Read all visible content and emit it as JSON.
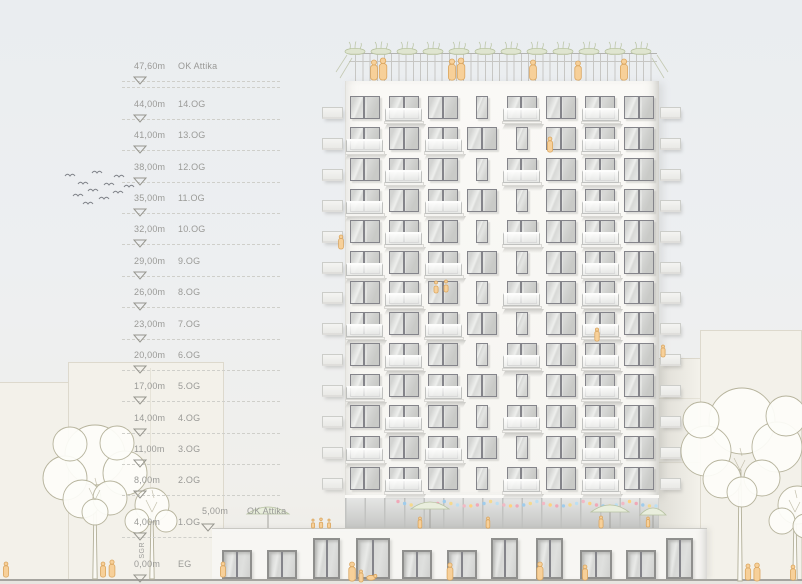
{
  "drawing": {
    "type": "building elevation",
    "levels": [
      {
        "value": "47,60m",
        "label": "OK Attika",
        "m": 47.6,
        "double_dash": true
      },
      {
        "value": "44,00m",
        "label": "14.OG",
        "m": 44
      },
      {
        "value": "41,00m",
        "label": "13.OG",
        "m": 41
      },
      {
        "value": "38,00m",
        "label": "12.OG",
        "m": 38
      },
      {
        "value": "35,00m",
        "label": "11.OG",
        "m": 35
      },
      {
        "value": "32,00m",
        "label": "10.OG",
        "m": 32
      },
      {
        "value": "29,00m",
        "label": "9.OG",
        "m": 29
      },
      {
        "value": "26,00m",
        "label": "8.OG",
        "m": 26
      },
      {
        "value": "23,00m",
        "label": "7.OG",
        "m": 23
      },
      {
        "value": "20,00m",
        "label": "6.OG",
        "m": 20
      },
      {
        "value": "17,00m",
        "label": "5.OG",
        "m": 17
      },
      {
        "value": "14,00m",
        "label": "4.OG",
        "m": 14
      },
      {
        "value": "11,00m",
        "label": "3.OG",
        "m": 11
      },
      {
        "value": "8,00m",
        "label": "2.OG",
        "m": 8
      },
      {
        "value": "4,00m",
        "label": "1.OG",
        "m": 4,
        "short": true
      },
      {
        "value": "0,00m",
        "label": "EG",
        "m": 0,
        "no_dash": true
      }
    ],
    "podium_marker": {
      "value": "5,00m",
      "label": "OK Attika"
    },
    "side_note": "SGR"
  },
  "colors": {
    "sky": "#eaedf0",
    "facade": "#f8f7f4",
    "window_frame": "#84848a",
    "people_accent": "#f7d099",
    "greenery": "#b6c19e",
    "marker_text": "#9a9a97",
    "street_line": "#a5a49f"
  },
  "tower": {
    "bays": 8,
    "floors": 13,
    "row_patterns": [
      "wbwnbwbw",
      "bwbwnwbw",
      "wbwnbwbw",
      "bwbwnwbw",
      "wbwnbwbw",
      "bwbwnwbw",
      "wbwnbwbw",
      "bwbwnwbw",
      "wbwnbwbw",
      "bwbwnwbw",
      "wbwnbwbw",
      "bwbwnwbw",
      "wbwnbwbw"
    ]
  },
  "storefront": {
    "openings": [
      {
        "x": 222,
        "w": 30,
        "t": "w"
      },
      {
        "x": 267,
        "w": 30,
        "t": "w"
      },
      {
        "x": 313,
        "w": 27,
        "t": "d"
      },
      {
        "x": 356,
        "w": 34,
        "t": "d"
      },
      {
        "x": 402,
        "w": 30,
        "t": "w"
      },
      {
        "x": 447,
        "w": 30,
        "t": "w"
      },
      {
        "x": 491,
        "w": 27,
        "t": "d"
      },
      {
        "x": 536,
        "w": 27,
        "t": "d"
      },
      {
        "x": 580,
        "w": 32,
        "t": "w"
      },
      {
        "x": 626,
        "w": 30,
        "t": "w"
      },
      {
        "x": 666,
        "w": 27,
        "t": "d"
      }
    ]
  },
  "scenery": {
    "bg_buildings": [
      {
        "x": -8,
        "y": 382,
        "w": 96
      },
      {
        "x": 68,
        "y": 362,
        "w": 156,
        "vlines": [
          150
        ]
      },
      {
        "x": 652,
        "y": 358,
        "w": 150,
        "hlines": [
          398,
          462
        ],
        "vlines": [
          700,
          758
        ]
      },
      {
        "x": 700,
        "y": 330,
        "w": 102
      }
    ],
    "trees": [
      {
        "x": 95,
        "base": 579,
        "top": 500,
        "blobs": [
          [
            95,
            455,
            30
          ],
          [
            65,
            478,
            22
          ],
          [
            125,
            473,
            22
          ],
          [
            82,
            499,
            19
          ],
          [
            110,
            498,
            17
          ],
          [
            70,
            444,
            17
          ],
          [
            117,
            443,
            17
          ],
          [
            95,
            512,
            13
          ]
        ]
      },
      {
        "x": 152,
        "base": 579,
        "top": 512,
        "blobs": [
          [
            152,
            505,
            17
          ],
          [
            137,
            521,
            12
          ],
          [
            166,
            521,
            11
          ]
        ]
      },
      {
        "x": 740,
        "base": 581,
        "top": 470,
        "blobs": [
          [
            742,
            421,
            33
          ],
          [
            706,
            451,
            25
          ],
          [
            777,
            447,
            25
          ],
          [
            722,
            479,
            19
          ],
          [
            762,
            478,
            18
          ],
          [
            701,
            420,
            18
          ],
          [
            786,
            416,
            20
          ],
          [
            742,
            492,
            15
          ]
        ]
      },
      {
        "x": 795,
        "base": 580,
        "top": 512,
        "blobs": [
          [
            797,
            505,
            19
          ],
          [
            782,
            521,
            13
          ],
          [
            805,
            526,
            12
          ]
        ]
      }
    ],
    "birds": [
      [
        70,
        176
      ],
      [
        83,
        184
      ],
      [
        97,
        173
      ],
      [
        78,
        196
      ],
      [
        93,
        191
      ],
      [
        109,
        185
      ],
      [
        119,
        177
      ],
      [
        88,
        204
      ],
      [
        104,
        199
      ],
      [
        118,
        193
      ],
      [
        129,
        187
      ]
    ],
    "umbrellas": [
      {
        "x": 268,
        "y": 505,
        "w": 42
      },
      {
        "x": 430,
        "y": 500,
        "w": 38
      },
      {
        "x": 610,
        "y": 503,
        "w": 38
      },
      {
        "x": 653,
        "y": 506,
        "w": 26
      }
    ],
    "bunting": {
      "x0": 398,
      "x1": 656,
      "count": 40,
      "colors": [
        "#f0a9b8",
        "#9fccec",
        "#f5d98d",
        "#bcdff2",
        "#f2b9c5",
        "#ffd27e"
      ]
    },
    "roof_planters_x": [
      355,
      381,
      407,
      433,
      459,
      485,
      511,
      537,
      563,
      589,
      615,
      641
    ],
    "people": [
      {
        "x": 374,
        "y": 80,
        "h": 20
      },
      {
        "x": 383,
        "y": 80,
        "h": 22
      },
      {
        "x": 452,
        "y": 80,
        "h": 21
      },
      {
        "x": 461,
        "y": 80,
        "h": 22
      },
      {
        "x": 533,
        "y": 80,
        "h": 20
      },
      {
        "x": 578,
        "y": 80,
        "h": 19
      },
      {
        "x": 624,
        "y": 80,
        "h": 21
      },
      {
        "x": 313,
        "y": 528,
        "h": 9,
        "k": "sit"
      },
      {
        "x": 321,
        "y": 528,
        "h": 10,
        "k": "sit"
      },
      {
        "x": 329,
        "y": 528,
        "h": 9,
        "k": "sit"
      },
      {
        "x": 420,
        "y": 528,
        "h": 11
      },
      {
        "x": 488,
        "y": 528,
        "h": 11
      },
      {
        "x": 601,
        "y": 528,
        "h": 12
      },
      {
        "x": 648,
        "y": 527,
        "h": 10
      },
      {
        "x": 550,
        "y": 152,
        "h": 15
      },
      {
        "x": 341,
        "y": 249,
        "h": 14
      },
      {
        "x": 436,
        "y": 293,
        "h": 12,
        "k": "sit"
      },
      {
        "x": 446,
        "y": 292,
        "h": 12,
        "k": "sit"
      },
      {
        "x": 663,
        "y": 357,
        "h": 12
      },
      {
        "x": 597,
        "y": 341,
        "h": 13
      },
      {
        "x": 6,
        "y": 577,
        "h": 15
      },
      {
        "x": 103,
        "y": 577,
        "h": 15
      },
      {
        "x": 112,
        "y": 577,
        "h": 17
      },
      {
        "x": 223,
        "y": 577,
        "h": 15
      },
      {
        "x": 352,
        "y": 581,
        "h": 19
      },
      {
        "x": 361,
        "y": 582,
        "h": 12
      },
      {
        "x": 371,
        "y": 581,
        "h": 7,
        "k": "dog"
      },
      {
        "x": 450,
        "y": 580,
        "h": 17
      },
      {
        "x": 540,
        "y": 580,
        "h": 18
      },
      {
        "x": 585,
        "y": 580,
        "h": 15
      },
      {
        "x": 748,
        "y": 580,
        "h": 16
      },
      {
        "x": 757,
        "y": 581,
        "h": 18
      },
      {
        "x": 793,
        "y": 580,
        "h": 15
      }
    ]
  }
}
